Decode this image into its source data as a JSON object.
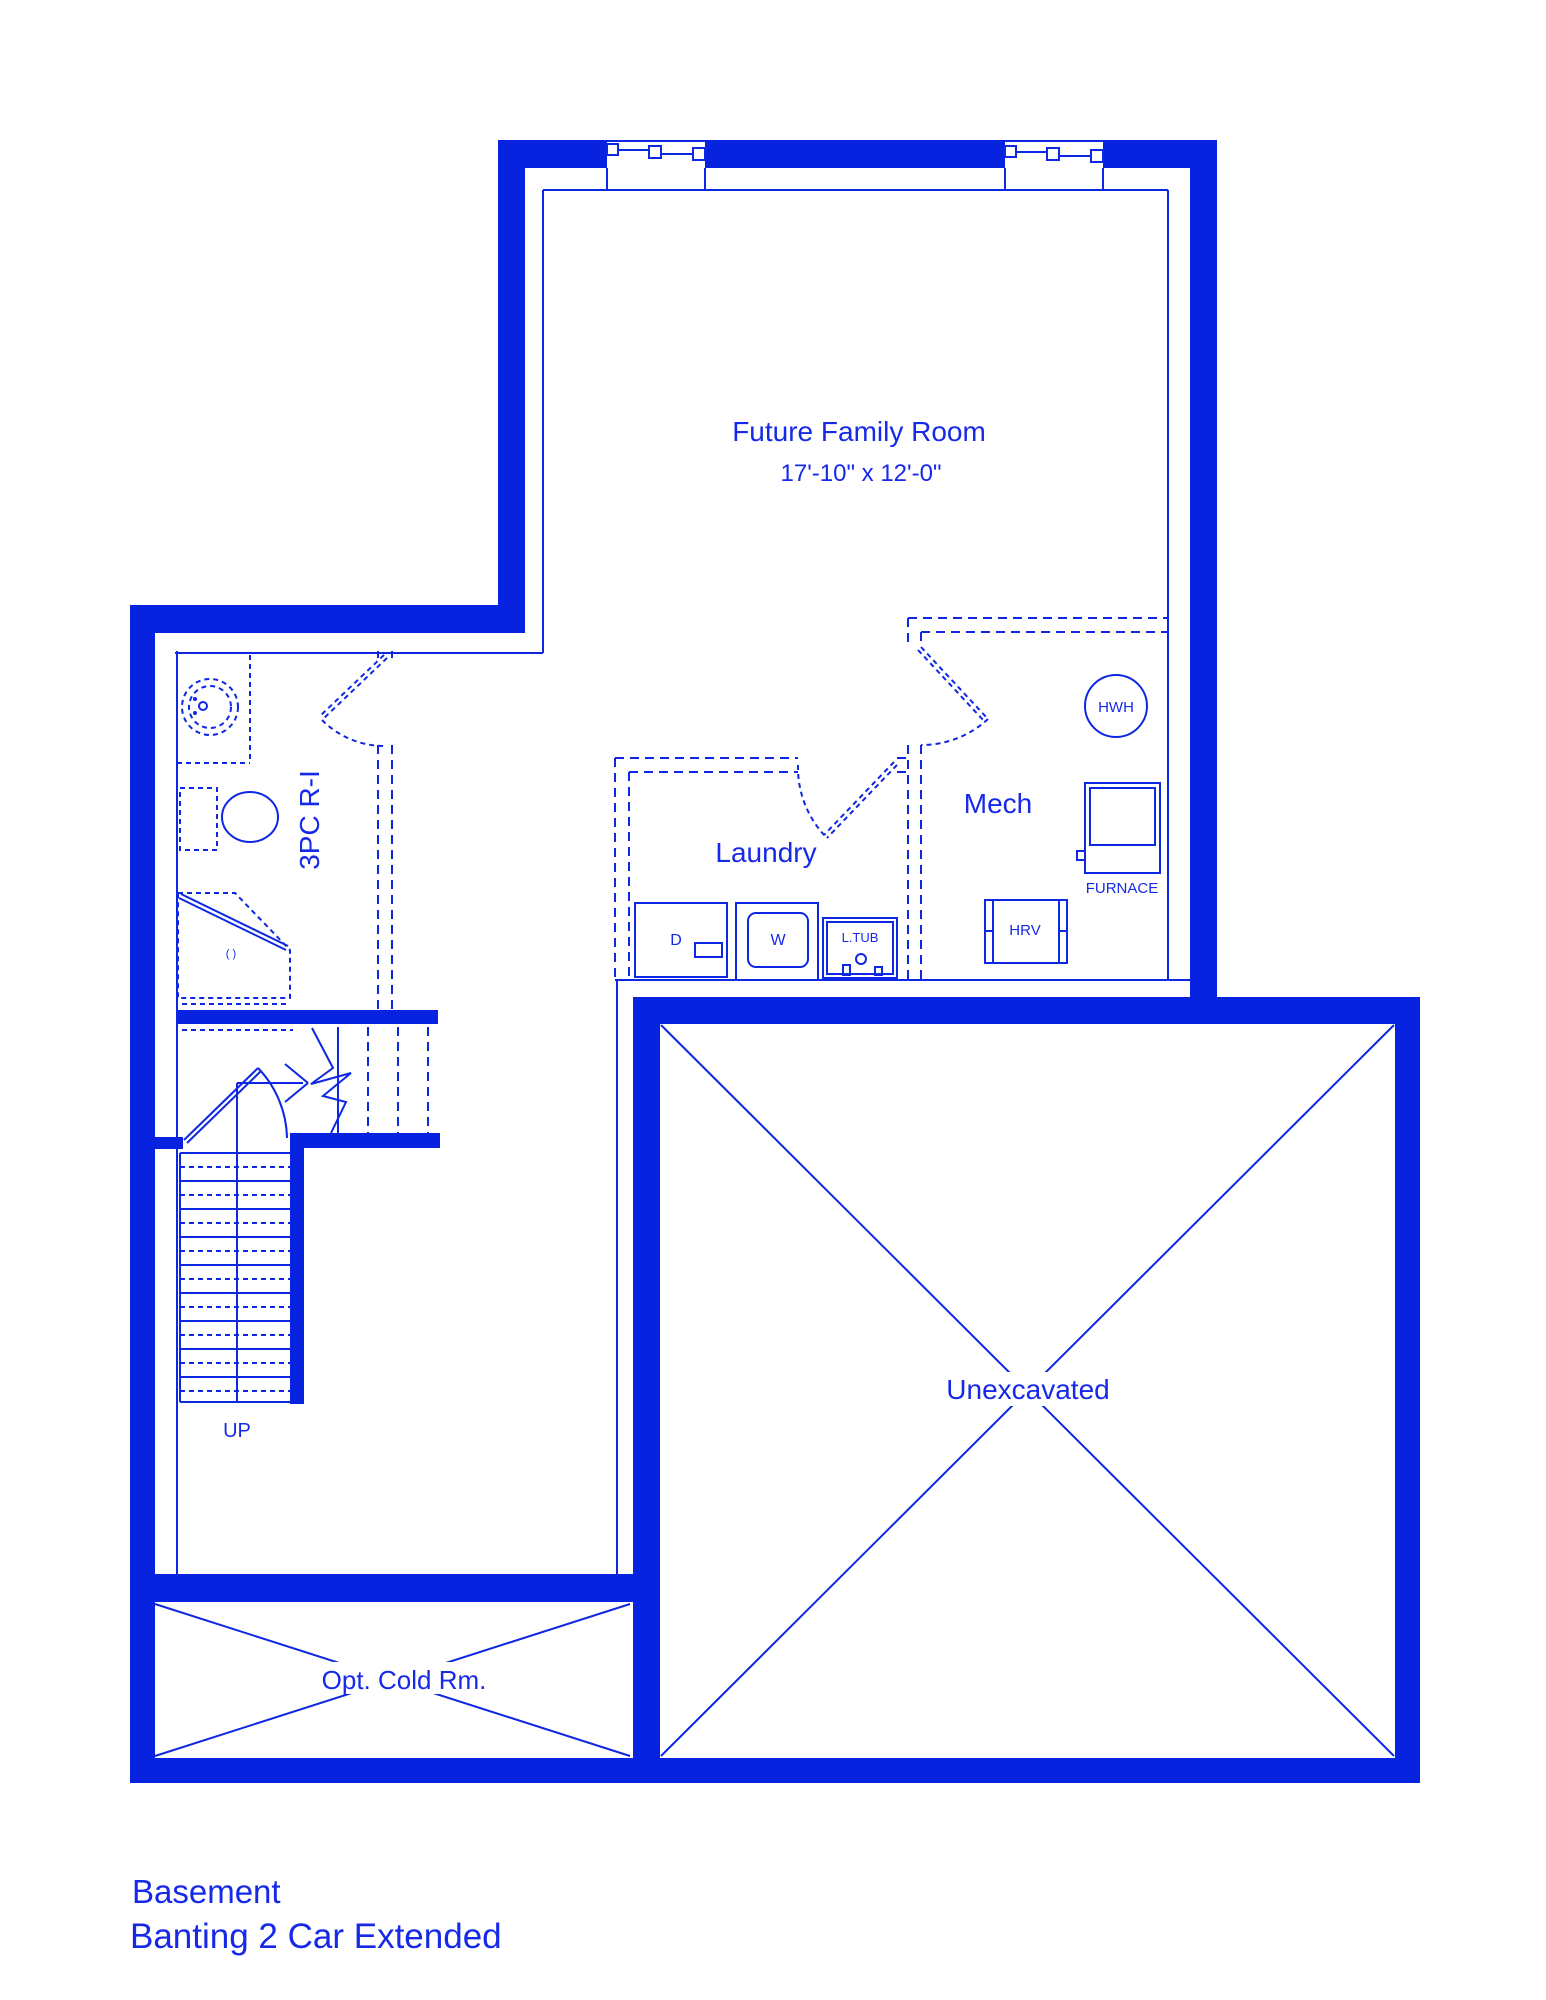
{
  "colors": {
    "wall": "#0823DF",
    "line": "#0E27E3",
    "text": "#1629E9",
    "background": "#FFFFFF"
  },
  "plan": {
    "rooms": {
      "future_family_room": {
        "label": "Future Family Room",
        "dimensions": "17'-10\" x 12'-0\""
      },
      "bathroom_rough_in": {
        "label": "3PC R-I"
      },
      "laundry": {
        "label": "Laundry"
      },
      "mech": {
        "label": "Mech"
      },
      "unexcavated": {
        "label": "Unexcavated"
      },
      "cold_room": {
        "label": "Opt. Cold Rm."
      }
    },
    "equipment": {
      "hot_water_heater": "HWH",
      "furnace": "FURNACE",
      "hrv": "HRV",
      "laundry_tub": "L.TUB",
      "washer": "W",
      "dryer": "D",
      "shower_drain": "( )",
      "stairs_direction": "UP"
    }
  },
  "title_block": {
    "floor": "Basement",
    "model": "Banting 2 Car Extended"
  }
}
